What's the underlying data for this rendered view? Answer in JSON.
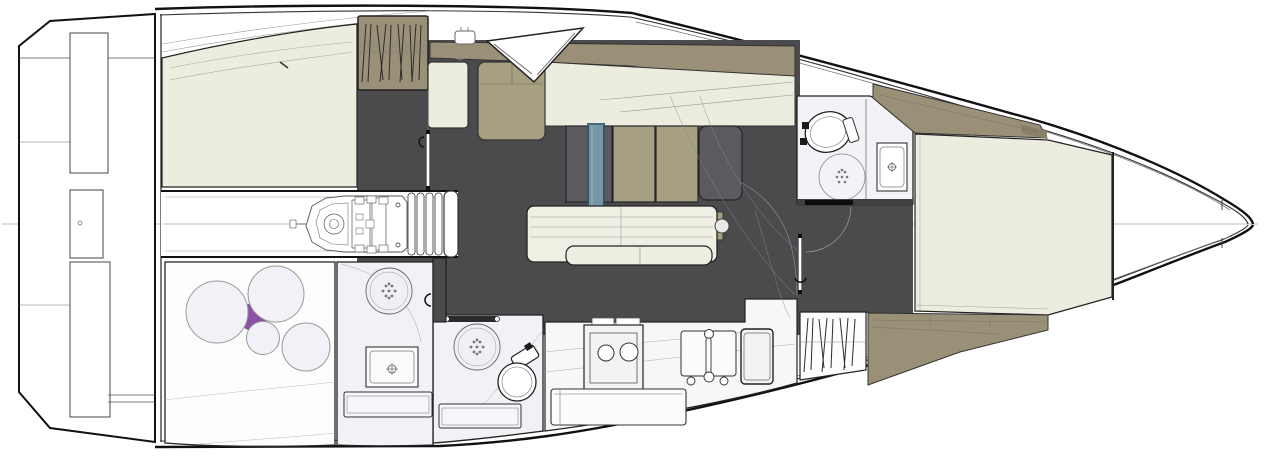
{
  "meta": {
    "title": "Sailing yacht interior layout plan",
    "view": "overhead deck plan, bow to the right, stern to the left"
  },
  "palette": {
    "hull_line": "#1a1a1a",
    "floor": "#4B4B4E",
    "cream": "#ECECDF",
    "khaki": "#A79F81",
    "khaki_dark": "#9A9077",
    "cushion_dark": "#5B5A5F",
    "mast_fill": "#7BA0B2",
    "mast_stroke": "#2E5767",
    "room": "#F1F1F6",
    "purple": "#8A50A6",
    "line_light": "#9a9a9a",
    "white": "#ffffff",
    "sill": "#3f3f42"
  },
  "regions": [
    {
      "name": "transom-swim-platform",
      "side": "stern"
    },
    {
      "name": "aft-berth-port",
      "surface": "cream mattress"
    },
    {
      "name": "hanging-locker-aft",
      "contents": "hangers"
    },
    {
      "name": "engine-compartment",
      "contents": "engine under companionway steps"
    },
    {
      "name": "companionway-steps",
      "steps": 5
    },
    {
      "name": "salon",
      "furniture": [
        "settee-cushions",
        "table",
        "bench",
        "mast"
      ]
    },
    {
      "name": "galley",
      "appliances": [
        "stove-2-burners",
        "sink",
        "fridge",
        "drawers"
      ]
    },
    {
      "name": "aft-head",
      "fixtures": [
        "shower",
        "toilet",
        "drawer"
      ]
    },
    {
      "name": "mid-head",
      "fixtures": [
        "shower",
        "sink",
        "drawer"
      ]
    },
    {
      "name": "aft-cabin-starboard",
      "decor": "four circles with purple accent"
    },
    {
      "name": "forward-head",
      "fixtures": [
        "toilet",
        "shower",
        "sink"
      ]
    },
    {
      "name": "hanging-locker-forward",
      "contents": "hangers"
    },
    {
      "name": "v-berth",
      "surface": "cream mattress with khaki hull shelves"
    },
    {
      "name": "bow-compartment",
      "contents": "anchor locker"
    }
  ]
}
